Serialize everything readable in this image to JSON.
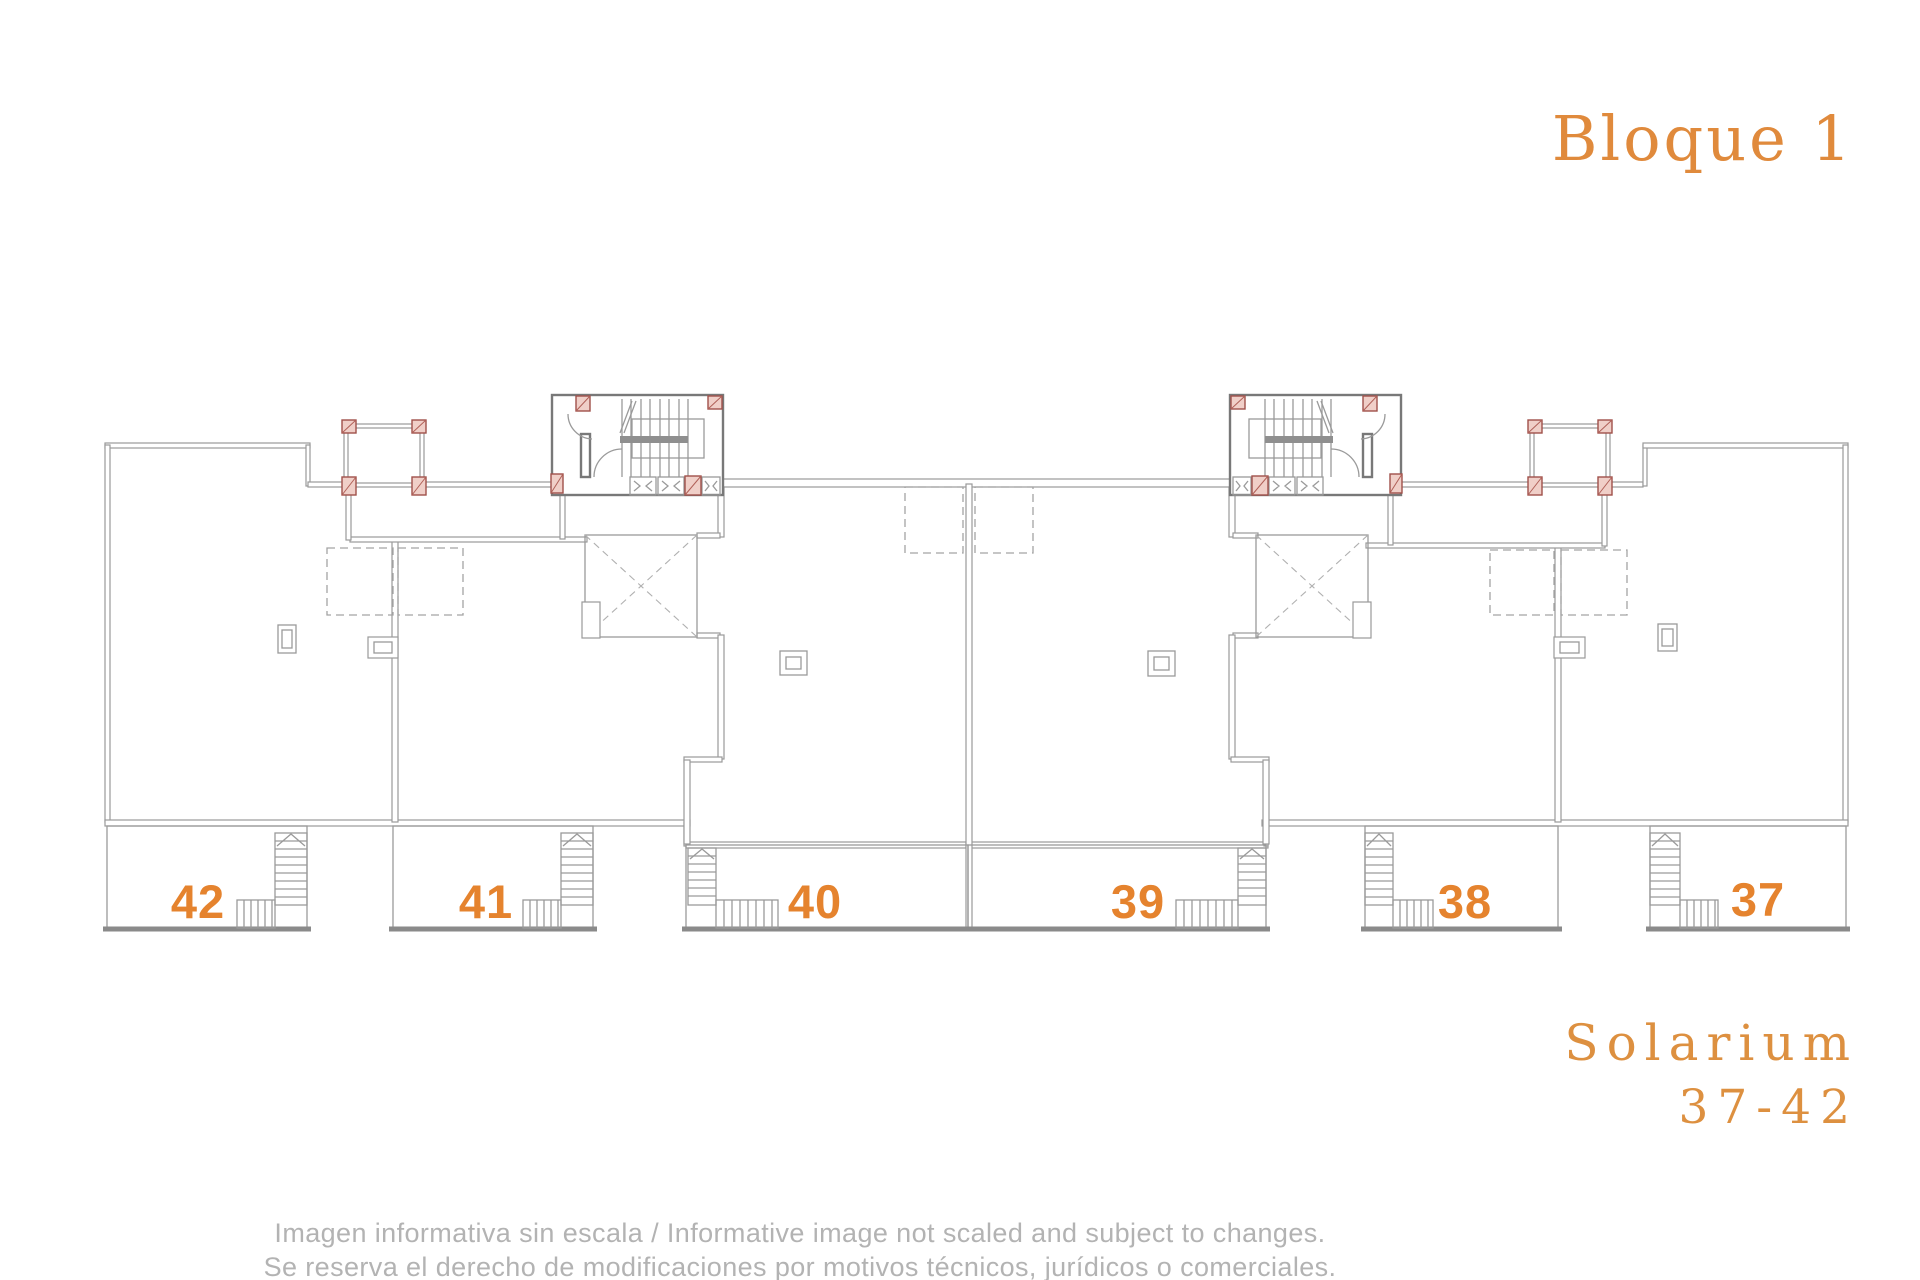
{
  "header": {
    "title": "Bloque 1"
  },
  "plan": {
    "units": [
      {
        "number": "42"
      },
      {
        "number": "41"
      },
      {
        "number": "40"
      },
      {
        "number": "39"
      },
      {
        "number": "38"
      },
      {
        "number": "37"
      }
    ]
  },
  "side_label": {
    "line1": "Solarium",
    "line2": "37-42"
  },
  "disclaimer": {
    "line1": "Imagen informativa sin escala / Informative image not scaled and subject to changes.",
    "line2": "Se reserva el derecho de modificaciones por motivos técnicos, jurídicos o comerciales."
  },
  "colors": {
    "accent_orange": "#e08a3c",
    "unit_number_orange": "#e5832e",
    "wall_gray": "#9a9a9a",
    "disclaimer_gray": "#b3b3b3",
    "column_fill": "#f0cfc8",
    "column_border": "#a0514a"
  }
}
